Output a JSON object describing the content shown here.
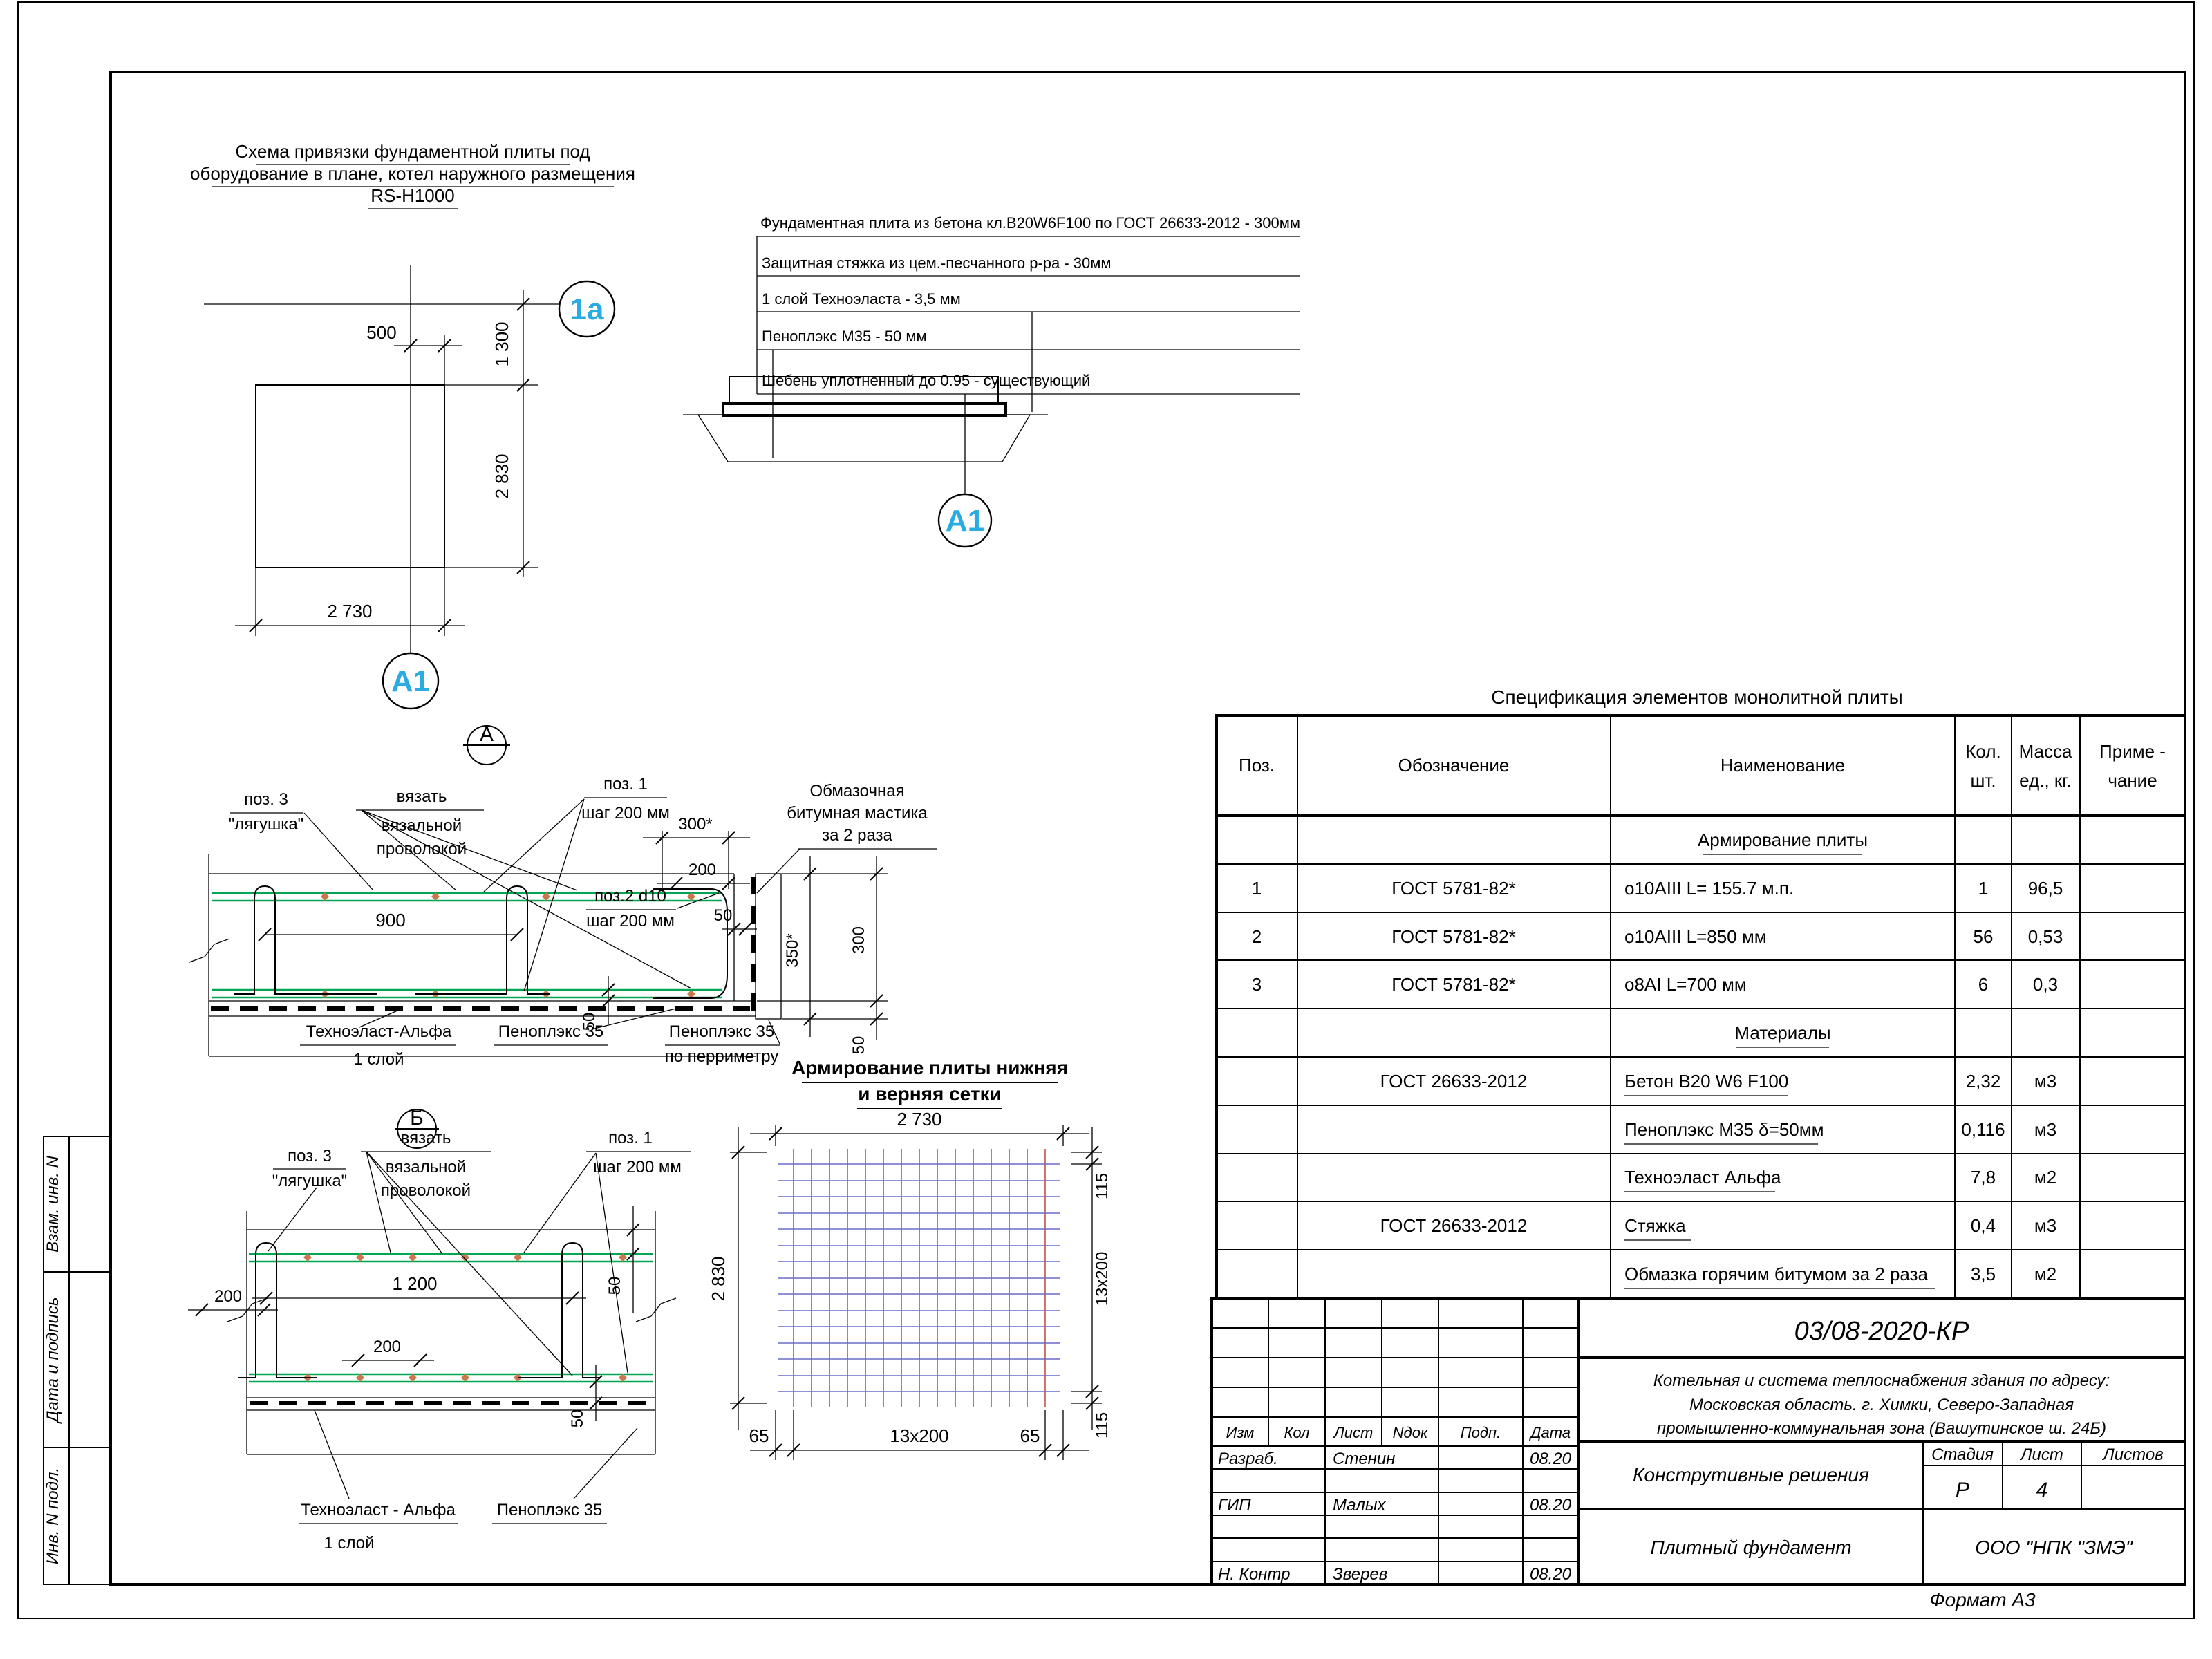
{
  "colors": {
    "marker-blue": "#2aabe2",
    "rebar-green": "#00a651",
    "mesh-red": "#c8504a",
    "mesh-blue": "#6b6bc8",
    "tie-diamond": "#c8784b"
  },
  "plan": {
    "title1": "Схема привязки фундаментной плиты под",
    "title2": "оборудование в плане, котел наружного размещения",
    "title3": "RS-H1000",
    "axis1": "1a",
    "axis2": "A1",
    "dim_500": "500",
    "dim_1300": "1 300",
    "dim_2830": "2 830",
    "dim_2730": "2 730"
  },
  "section": {
    "marker": "A1",
    "layer1": "Фундаментная плита из бетона кл.B20W6F100 по ГОСТ 26633-2012 - 300мм",
    "layer2": "Защитная стяжка из цем.-песчанного р-ра - 30мм",
    "layer3": "1 слой Техноэласта - 3,5 мм",
    "layer4": "Пеноплэкс М35 - 50 мм",
    "layer5": "Шебень уплотненный до 0.95 - существующий"
  },
  "detailA": {
    "marker": "А",
    "poz3a": "поз. 3",
    "poz3b": "\"лягушка\"",
    "tie1": "вязать",
    "tie2": "вязальной",
    "tie3": "проволокой",
    "poz1a": "поз. 1",
    "poz1b": "шаг 200 мм",
    "mastic1": "Обмазочная",
    "mastic2": "битумная мастика",
    "mastic3": "за 2 раза",
    "dim900": "900",
    "dim300s": "300*",
    "dim200": "200",
    "poz2a": "поз.2 d10",
    "poz2b": "шаг 200 мм",
    "dim50_edge": "50",
    "dim350s": "350*",
    "dim300": "300",
    "dim50_right": "50",
    "dim50_cover": "50",
    "tech1": "Техноэласт-Альфа",
    "tech2": "1 слой",
    "peno": "Пеноплэкс 35",
    "peno_per1": "Пеноплэкс 35",
    "peno_per2": "по перриметру"
  },
  "detailB": {
    "marker": "Б",
    "poz3a": "поз. 3",
    "poz3b": "\"лягушка\"",
    "tie1": "вязать",
    "tie2": "вязальной",
    "tie3": "проволокой",
    "poz1a": "поз. 1",
    "poz1b": "шаг 200 мм",
    "dim200l": "200",
    "dim1200": "1 200",
    "dim50top": "50",
    "dim200c": "200",
    "dim50bot": "50",
    "tech1": "Техноэласт - Альфа",
    "tech2": "1 слой",
    "peno": "Пеноплэкс 35"
  },
  "mesh": {
    "title1": "Армирование плиты нижняя",
    "title2": "и верняя сетки",
    "dim_top": "2 730",
    "dim_left": "2 830",
    "dim_r115t": "115",
    "dim_r13x200": "13x200",
    "dim_r115b": "115",
    "dim_b65l": "65",
    "dim_b13x200": "13x200",
    "dim_b65r": "65"
  },
  "spec": {
    "title": "Спецификация элементов монолитной плиты",
    "h_poz": "Поз.",
    "h_oboz": "Обозначение",
    "h_name": "Наименование",
    "h_qty1": "Кол.",
    "h_qty2": "шт.",
    "h_mass1": "Масса",
    "h_mass2": "ед., кг.",
    "h_note1": "Приме -",
    "h_note2": "чание",
    "sec1": "Армирование плиты",
    "rows": [
      {
        "poz": "1",
        "oboz": "ГОСТ 5781-82*",
        "name": "o10AIII L= 155.7 м.п.",
        "qty": "1",
        "mass": "96,5"
      },
      {
        "poz": "2",
        "oboz": "ГОСТ 5781-82*",
        "name": "o10AIII L=850 мм",
        "qty": "56",
        "mass": "0,53"
      },
      {
        "poz": "3",
        "oboz": "ГОСТ 5781-82*",
        "name": "o8AI L=700 мм",
        "qty": "6",
        "mass": "0,3"
      }
    ],
    "sec2": "Материалы",
    "mats": [
      {
        "oboz": "ГОСТ 26633-2012",
        "name": "Бетон B20 W6 F100",
        "qty": "2,32",
        "mass": "м3"
      },
      {
        "oboz": "",
        "name": "Пеноплэкс М35 δ=50мм",
        "qty": "0,116",
        "mass": "м3"
      },
      {
        "oboz": "",
        "name": "Техноэласт Альфа",
        "qty": "7,8",
        "mass": "м2"
      },
      {
        "oboz": "ГОСТ 26633-2012",
        "name": "Стяжка",
        "qty": "0,4",
        "mass": "м3"
      },
      {
        "oboz": "",
        "name": "Обмазка горячим битумом за 2 раза",
        "qty": "3,5",
        "mass": "м2"
      }
    ]
  },
  "stamp": {
    "doc": "03/08-2020-КР",
    "proj1": "Котельная и система теплоснабжения здания по адресу:",
    "proj2": "Московская область. г. Химки, Северо-Западная",
    "proj3": "промышленно-коммунальная зона (Вашутинское ш. 24Б)",
    "object": "Конструтивные решения",
    "sheet_title": "Плитный фундамент",
    "company": "ООО \"НПК \"ЗМЭ\"",
    "h_izm": "Изм",
    "h_kol": "Кол",
    "h_list": "Лист",
    "h_ndok": "Nдок",
    "h_podp": "Подп.",
    "h_data": "Дата",
    "r1_role": "Разраб.",
    "r1_name": "Стенин",
    "r1_date": "08.20",
    "r2_role": "ГИП",
    "r2_name": "Малых",
    "r2_date": "08.20",
    "r3_role": "Н. Контр",
    "r3_name": "Зверев",
    "r3_date": "08.20",
    "h_stage": "Стадия",
    "h_sheet": "Лист",
    "h_sheets": "Листов",
    "stage": "Р",
    "sheet_num": "4"
  },
  "side": {
    "s1": "Взам. инв. N",
    "s2": "Дата и подпись",
    "s3": "Инв. N подл."
  },
  "footer": {
    "format": "Формат А3"
  }
}
